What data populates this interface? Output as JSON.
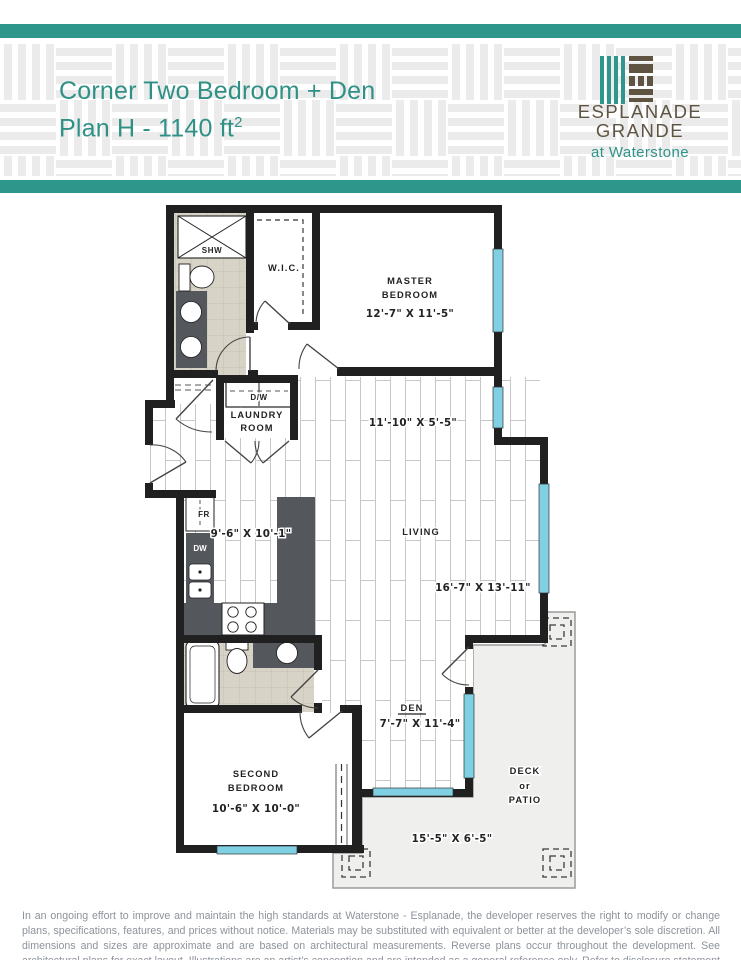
{
  "header": {
    "title_line1": "Corner Two Bedroom + Den",
    "title_line2": "Plan H - 1140 ft",
    "title_superscript": "2",
    "brand": {
      "name_line1": "ESPLANADE",
      "name_line2": "GRANDE",
      "tagline": "at Waterstone"
    }
  },
  "colors": {
    "accent_teal": "#2F968B",
    "brand_brown": "#5F5442",
    "window_cyan": "#7FD0E3",
    "wall_black": "#202020",
    "counter_gray": "#54575C",
    "tile_beige": "#D7D3C6",
    "deck_gray": "#EFEFED",
    "disclaimer_gray": "#8D939B"
  },
  "floorplan": {
    "master": {
      "name1": "MASTER",
      "name2": "BEDROOM",
      "dim": "12'-7\" X 11'-5\""
    },
    "wic": {
      "label": "W.I.C."
    },
    "shower": {
      "label": "SHW"
    },
    "laundry": {
      "appliance": "D/W",
      "name1": "LAUNDRY",
      "name2": "ROOM"
    },
    "hall": {
      "dim": "11'-10\" X 5'-5\""
    },
    "kitchen": {
      "fridge": "FR",
      "dishwasher": "DW",
      "dim": "9'-6\" X 10'-1\""
    },
    "living": {
      "name": "LIVING",
      "dim": "16'-7\" X 13'-11\""
    },
    "den": {
      "name": "DEN",
      "dim": "7'-7\" X 11'-4\""
    },
    "second_bedroom": {
      "name1": "SECOND",
      "name2": "BEDROOM",
      "dim": "10'-6\" X 10'-0\""
    },
    "deck": {
      "name1": "DECK",
      "name2": "or",
      "name3": "PATIO",
      "dim": "15'-5\" X 6'-5\""
    }
  },
  "disclaimer": "In an ongoing effort to improve and maintain the high standards at Waterstone - Esplanade, the developer reserves the right to modify or change plans, specifications, features, and prices without notice. Materials may be substituted with equivalent or better at the developer’s sole discretion. All dimensions and sizes are approximate and are based on architectural measurements. Reverse plans occur throughout the development. See architectural plans for exact layout. Illustrations are an artist’s conception and are intended as a general reference only. Refer to disclosure statement for specific offering details. E. & O. E."
}
